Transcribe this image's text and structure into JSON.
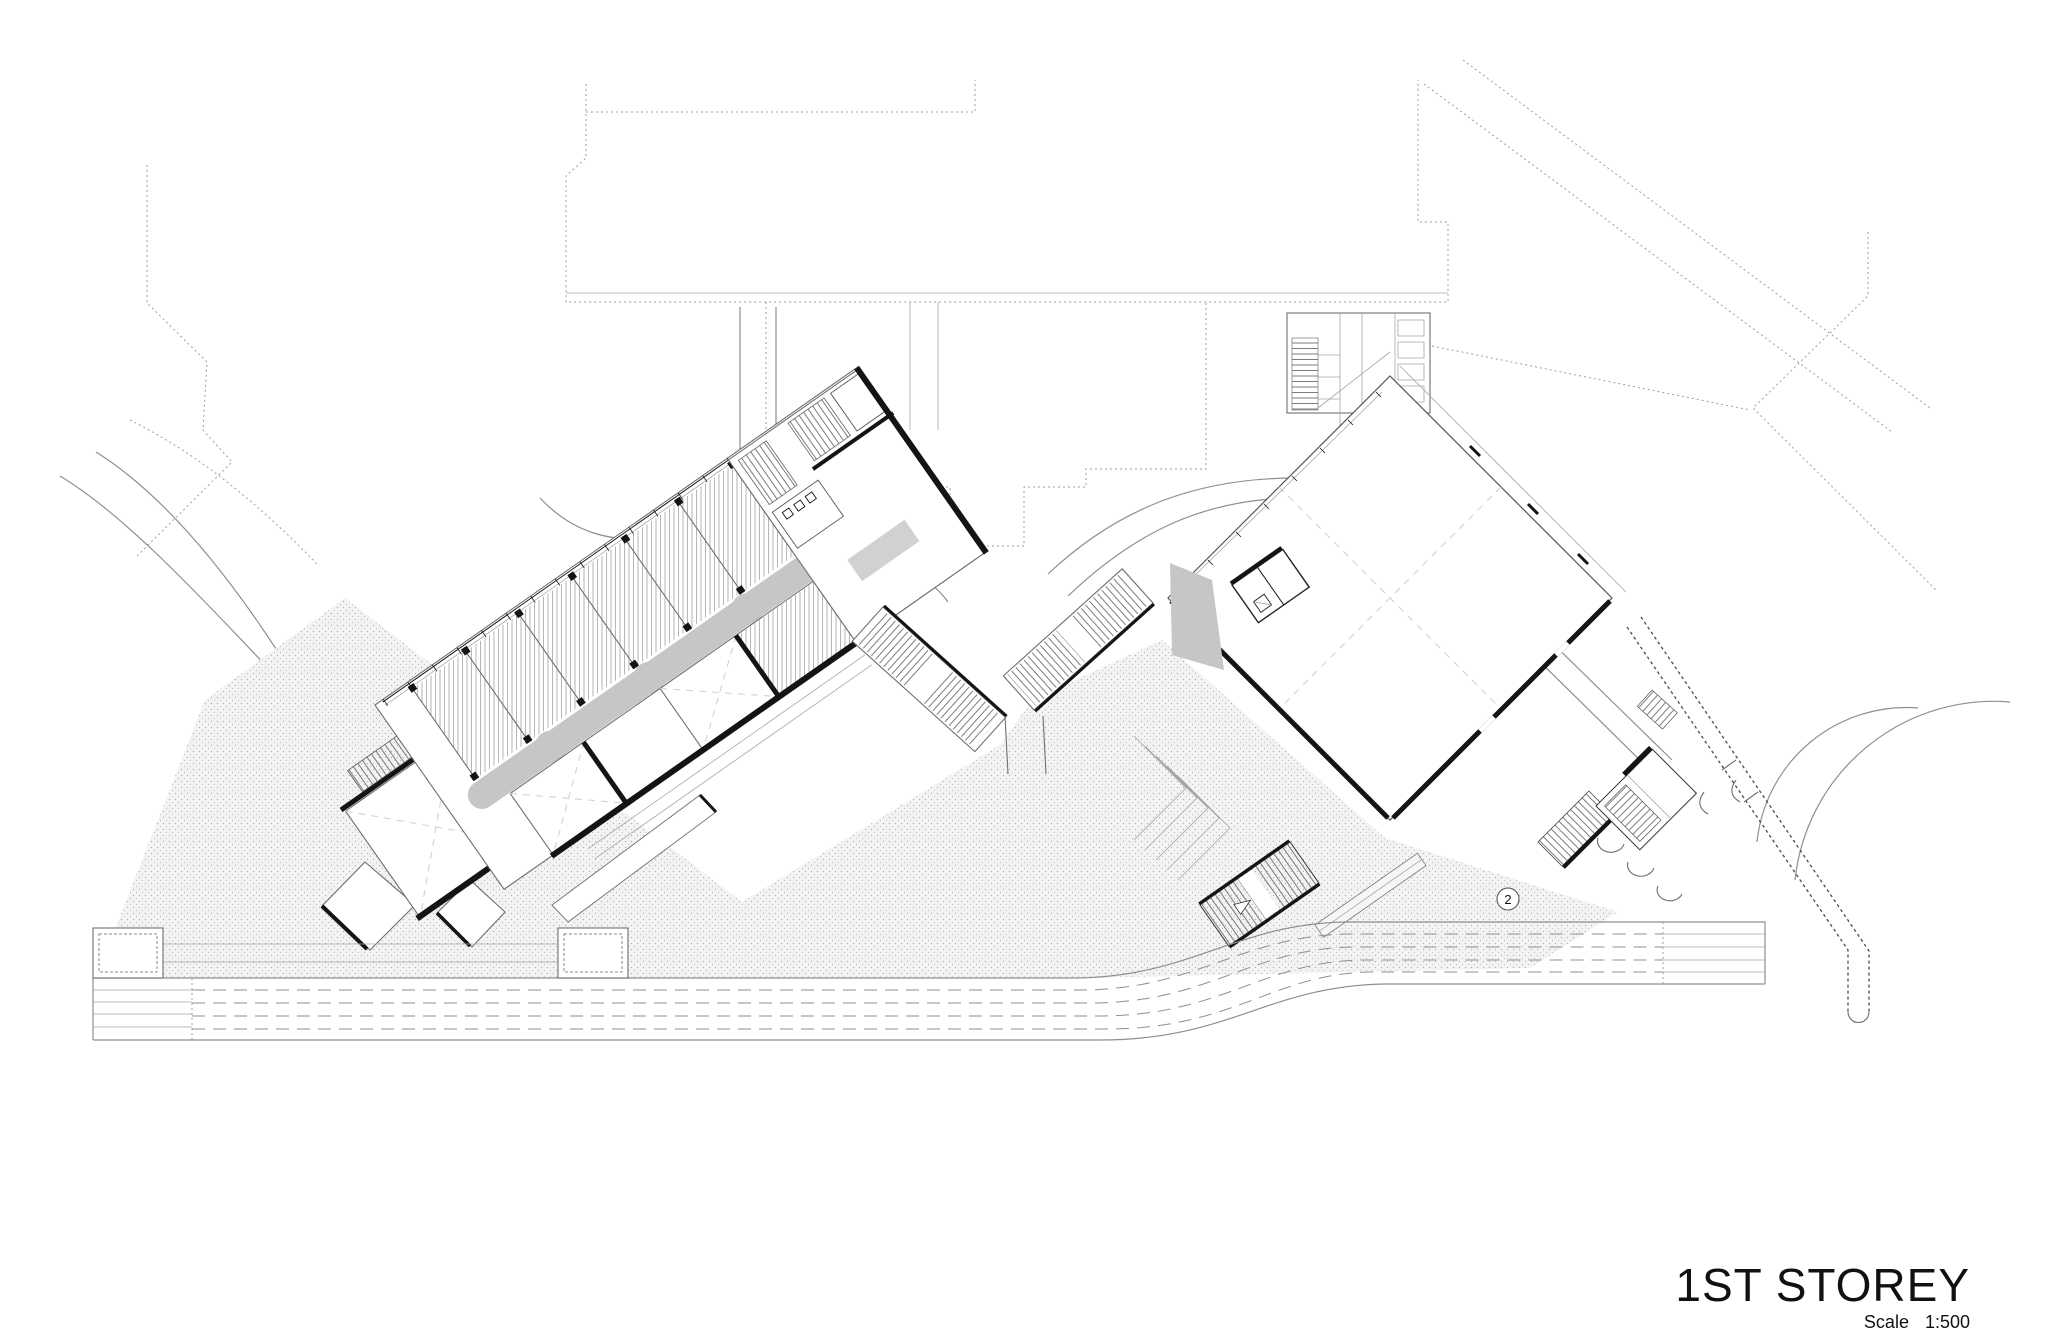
{
  "drawing": {
    "title": "1ST STOREY",
    "scale_label": "Scale",
    "scale_value": "1:500",
    "marker_2": "2"
  },
  "colors": {
    "line": "#6f6f6f",
    "line_dark": "#141414",
    "line_light": "#a6a6a6",
    "road": "#8f8f8f",
    "context": "#9e9e9e",
    "corridor": "#c6c6c6",
    "plaza_bg": "#f3f3f3",
    "plaza_dot": "#aeaeae",
    "hatch": "#a3a3a3",
    "tread": "#6e6e6e",
    "xdash": "#d2d2d2",
    "text": "#111111"
  }
}
